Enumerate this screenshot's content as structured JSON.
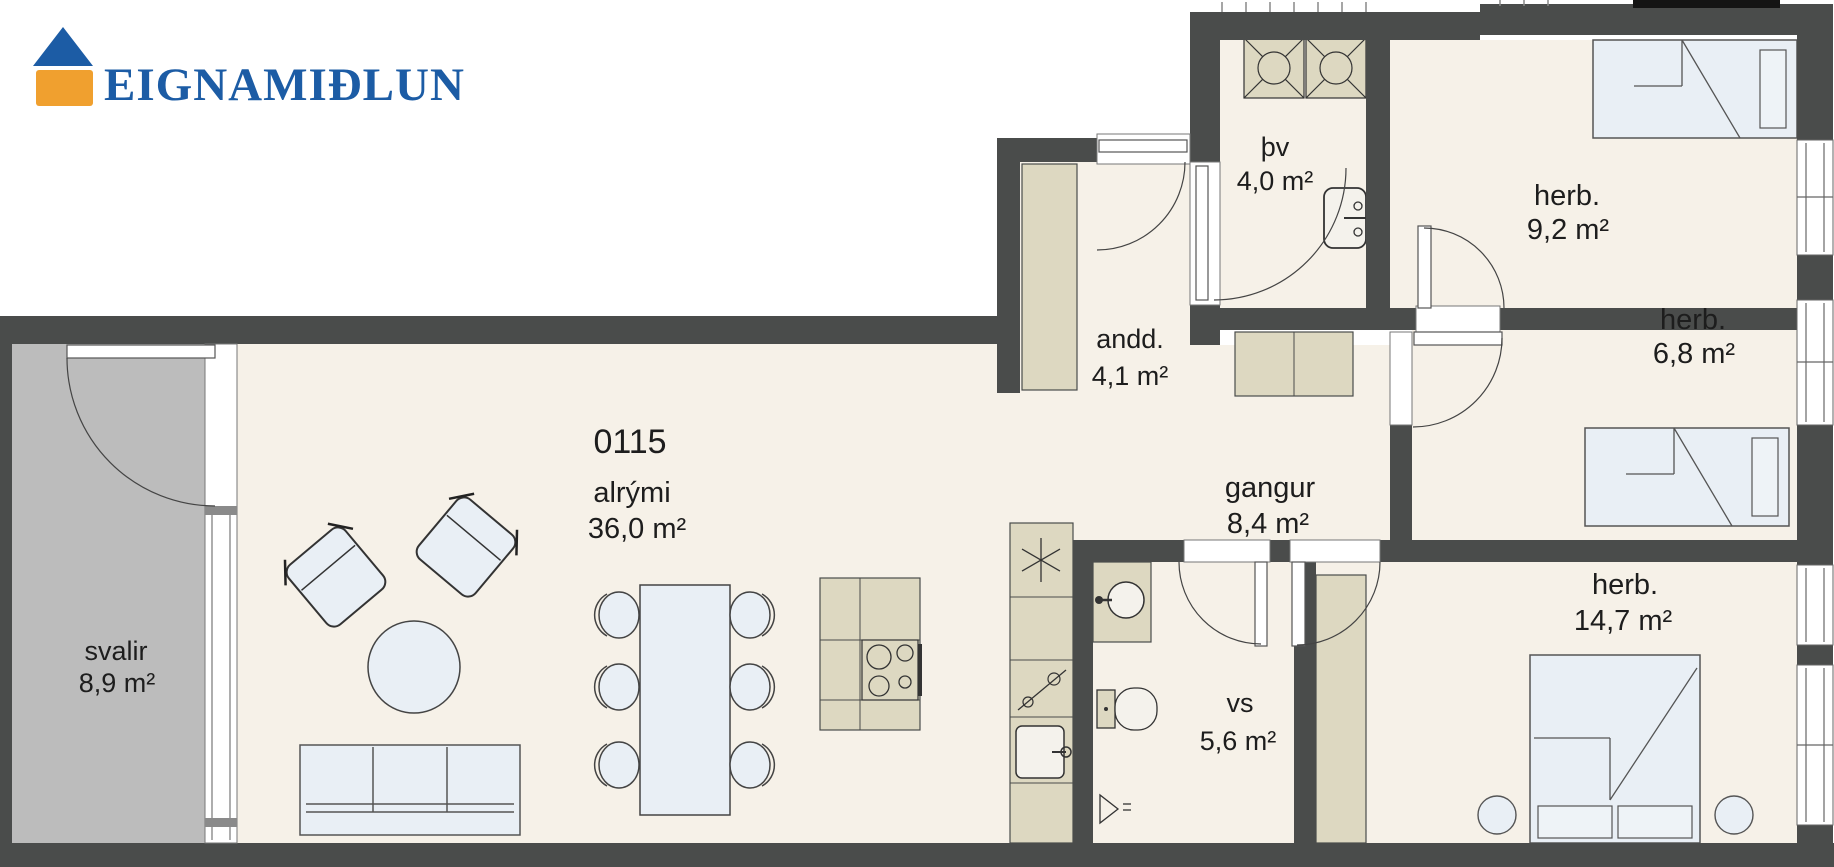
{
  "brand": {
    "name": "EIGNAMIÐLUN"
  },
  "unit": {
    "id": "0115"
  },
  "rooms": {
    "svalir": {
      "name": "svalir",
      "area": "8,9 m²"
    },
    "alrymi": {
      "name": "alrými",
      "area": "36,0 m²"
    },
    "andd": {
      "name": "andd.",
      "area": "4,1 m²"
    },
    "thv": {
      "name": "þv",
      "area": "4,0 m²"
    },
    "herb_92": {
      "name": "herb.",
      "area": "9,2 m²"
    },
    "herb_68": {
      "name": "herb.",
      "area": "6,8 m²"
    },
    "gangur": {
      "name": "gangur",
      "area": "8,4 m²"
    },
    "vs": {
      "name": "vs",
      "area": "5,6 m²"
    },
    "herb_147": {
      "name": "herb.",
      "area": "14,7 m²"
    }
  },
  "colors": {
    "wall": "#4a4c4b",
    "floor": "#f6f1e8",
    "balcony": "#bcbcbc",
    "furniture_beige": "#ddd8c1",
    "furniture_blue": "#e9eff5",
    "logo_blue": "#1c5ca5",
    "logo_orange": "#f0a02f"
  }
}
